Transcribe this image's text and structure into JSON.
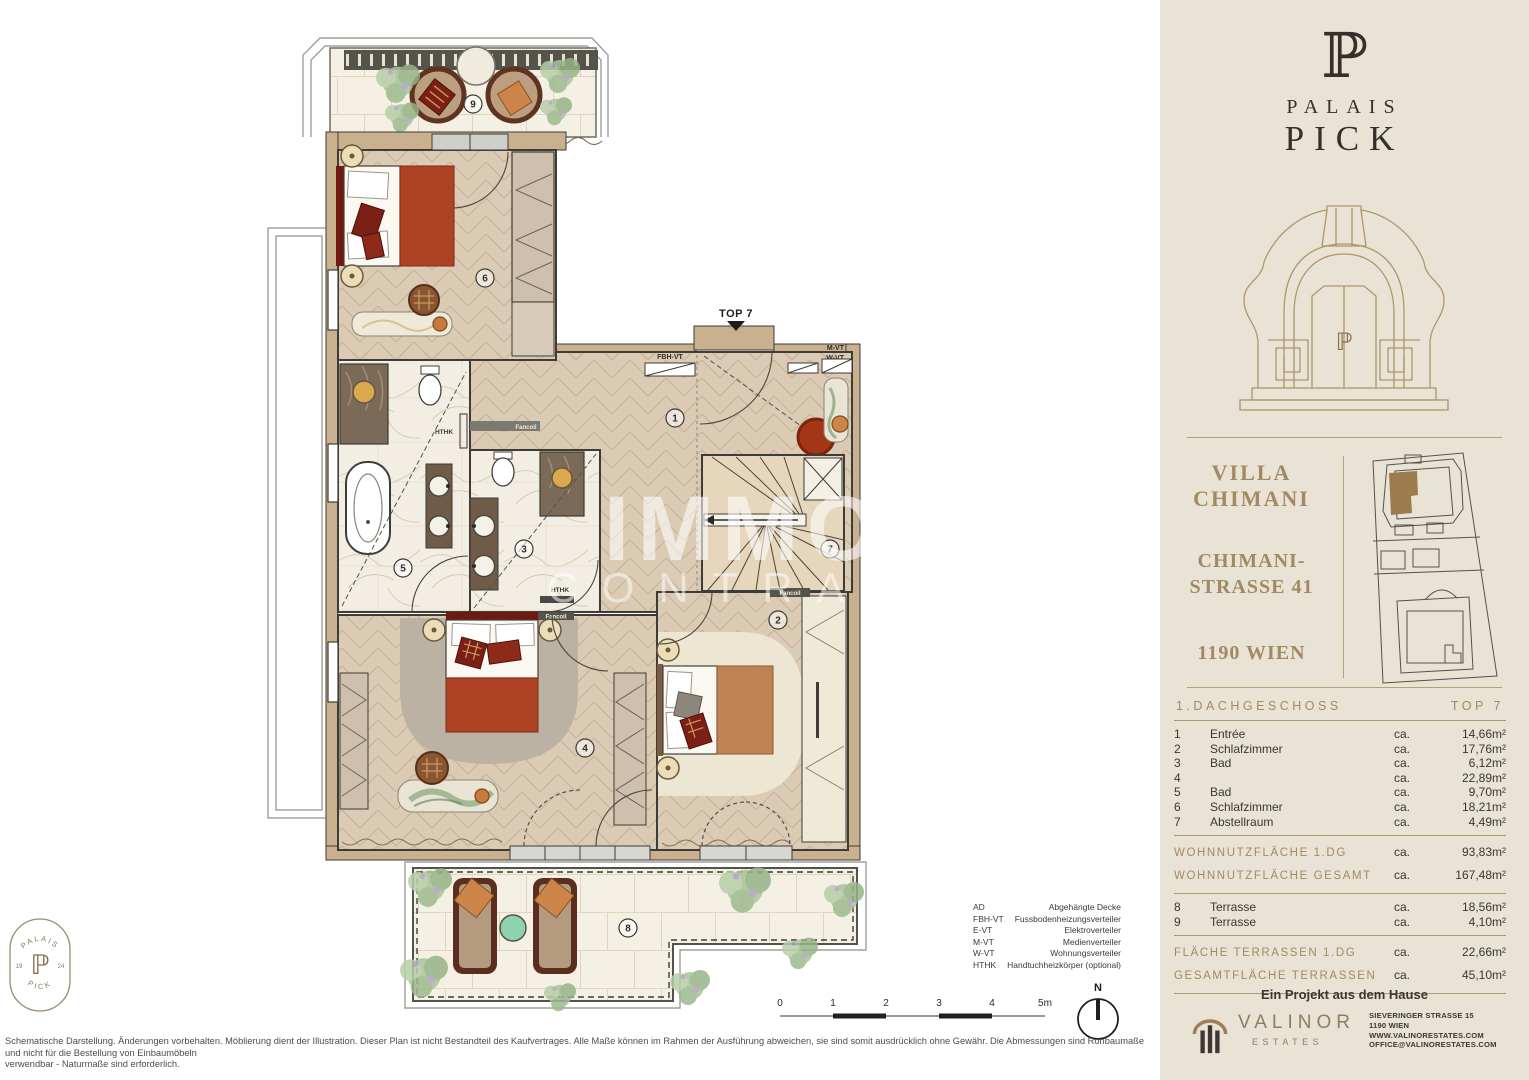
{
  "sidebar": {
    "logo": {
      "monogram": "ℙ",
      "word1": "PALAIS",
      "word2": "PICK",
      "portal_monogram": "ℙ"
    },
    "project": {
      "name1": "VILLA",
      "name2": "CHIMANI",
      "street1": "CHIMANI-",
      "street2": "STRASSE 41",
      "city": "1190 WIEN"
    },
    "table": {
      "floor": "1.DACHGESCHOSS",
      "unit": "TOP 7",
      "rooms": [
        {
          "num": "1",
          "name": "Entrée",
          "ca": "ca.",
          "area": "14,66m²"
        },
        {
          "num": "2",
          "name": "Schlafzimmer",
          "ca": "ca.",
          "area": "17,76m²"
        },
        {
          "num": "3",
          "name": "Bad",
          "ca": "ca.",
          "area": "6,12m²"
        },
        {
          "num": "4",
          "name": "Schlafzimmer",
          "ca": "ca.",
          "area": "22,89m²"
        },
        {
          "num": "5",
          "name": "Bad",
          "ca": "ca.",
          "area": "9,70m²"
        },
        {
          "num": "6",
          "name": "Schlafzimmer",
          "ca": "ca.",
          "area": "18,21m²"
        },
        {
          "num": "7",
          "name": "Abstellraum",
          "ca": "ca.",
          "area": "4,49m²"
        }
      ],
      "summary1": [
        {
          "label": "WOHNNUTZFLÄCHE 1.DG",
          "ca": "ca.",
          "area": "93,83m²"
        },
        {
          "label": "WOHNNUTZFLÄCHE GESAMT",
          "ca": "ca.",
          "area": "167,48m²"
        }
      ],
      "terraces": [
        {
          "num": "8",
          "name": "Terrasse",
          "ca": "ca.",
          "area": "18,56m²"
        },
        {
          "num": "9",
          "name": "Terrasse",
          "ca": "ca.",
          "area": "4,10m²"
        }
      ],
      "summary2": [
        {
          "label": "FLÄCHE TERRASSEN 1.DG",
          "ca": "ca.",
          "area": "22,66m²"
        },
        {
          "label": "GESAMTFLÄCHE TERRASSEN",
          "ca": "ca.",
          "area": "45,10m²"
        }
      ]
    },
    "footer": {
      "project_line": "Ein Projekt aus dem Hause",
      "brand": "VALINOR",
      "brand_sub": "ESTATES",
      "contact1": "SIEVERINGER STRASSE 15",
      "contact2": "1190 WIEN",
      "contact3": "WWW.VALINORESTATES.COM",
      "contact4": "OFFICE@VALINORESTATES.COM"
    }
  },
  "plan": {
    "entry_label": "TOP 7",
    "markers": [
      "1",
      "2",
      "3",
      "4",
      "5",
      "6",
      "7",
      "8",
      "9"
    ],
    "labels": {
      "fbh": "FBH-VT",
      "mvt": "M-VT",
      "wvt": "W-VT",
      "fancoil": "Fancoil",
      "hthk": "HTHK"
    },
    "watermark1": "IMMO",
    "watermark2": "CONTRACT",
    "scale": [
      "0",
      "1",
      "2",
      "3",
      "4",
      "5m"
    ],
    "north": "N",
    "legend": [
      {
        "abbr": "AD",
        "label": "Abgehängte Decke"
      },
      {
        "abbr": "FBH-VT",
        "label": "Fussbodenheizungsverteiler"
      },
      {
        "abbr": "E-VT",
        "label": "Elektroverteiler"
      },
      {
        "abbr": "M-VT",
        "label": "Medienverteiler"
      },
      {
        "abbr": "W-VT",
        "label": "Wohnungsverteiler"
      },
      {
        "abbr": "HTHK",
        "label": "Handtuchheizkörper (optional)"
      }
    ],
    "disclaimer1": "Schematische Darstellung. Änderungen vorbehalten. Möblierung dient der Illustration. Dieser Plan ist nicht Bestandteil des Kaufvertrages. Alle Maße können im Rahmen der Ausführung abweichen, sie sind somit ausdrücklich ohne Gewähr. Die Abmessungen sind Rohbaumaße und nicht für die Bestellung von Einbaumöbeln",
    "disclaimer2": "verwendbar - Naturmaße sind erforderlich."
  },
  "badge": {
    "top": "PALAIS",
    "bottom": "PICK",
    "left": "19",
    "right": "24",
    "monogram": "ℙ"
  }
}
